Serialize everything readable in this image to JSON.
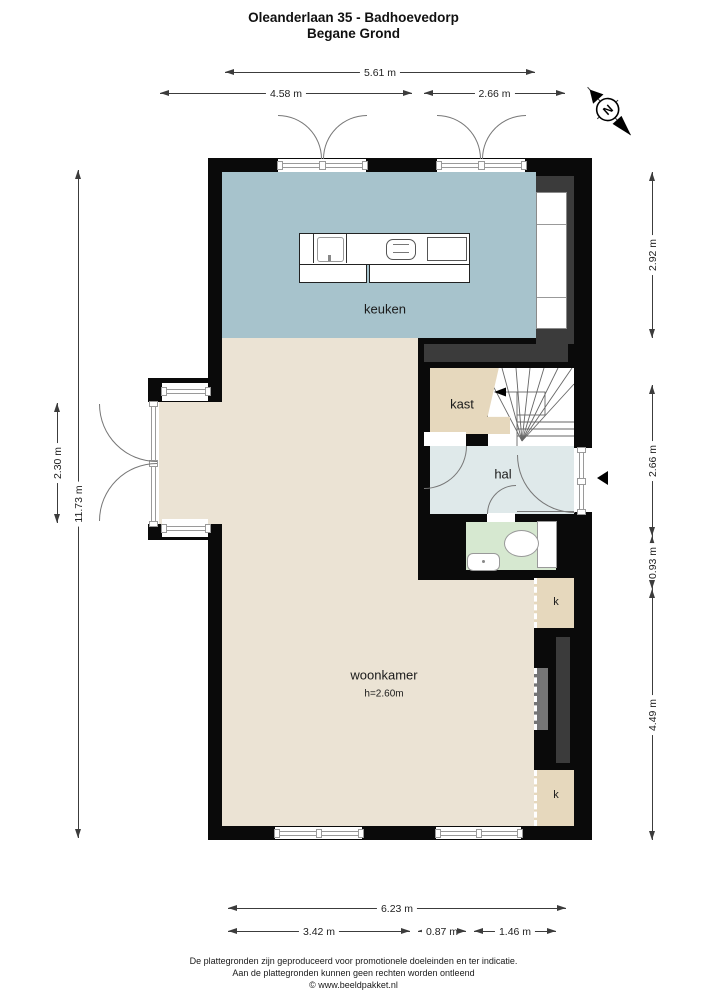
{
  "title": {
    "line1": "Oleanderlaan 35 - Badhoevedorp",
    "line2": "Begane Grond"
  },
  "compass": {
    "north_label": "N"
  },
  "rooms": {
    "keuken": {
      "label": "keuken"
    },
    "kast": {
      "label": "kast"
    },
    "hal": {
      "label": "hal"
    },
    "woonkamer": {
      "label": "woonkamer",
      "ceiling_height": "h=2.60m"
    },
    "closet_top": {
      "label": "k"
    },
    "closet_bottom": {
      "label": "k"
    }
  },
  "dimensions": {
    "top": [
      {
        "label": "5.61 m"
      },
      {
        "label": "4.58 m"
      },
      {
        "label": "2.66 m"
      }
    ],
    "right": [
      {
        "label": "2.92 m"
      },
      {
        "label": "2.66 m"
      },
      {
        "label": "0.93 m"
      },
      {
        "label": "4.49 m"
      }
    ],
    "left": [
      {
        "label": "2.30 m"
      },
      {
        "label": "11.73 m"
      }
    ],
    "bottom": [
      {
        "label": "6.23 m"
      },
      {
        "label": "3.42 m"
      },
      {
        "label": "0.87 m"
      },
      {
        "label": "1.46 m"
      }
    ]
  },
  "footer": {
    "line1": "De plattegronden zijn geproduceerd voor promotionele doeleinden en ter indicatie.",
    "line2": "Aan de plattegronden kunnen geen rechten worden ontleend",
    "line3": "© www.beeldpakket.nl"
  },
  "colors": {
    "wall": "#0a0a0a",
    "wall-inset": "#3b3b3b",
    "keuken": "#a7c3cc",
    "woonkamer": "#ebe3d4",
    "kast": "#e6d8bd",
    "hal": "#dfe9ea",
    "toilet": "#d6e8d0",
    "glazing": "#9a9a9a",
    "dim": "#3c3c3c"
  }
}
